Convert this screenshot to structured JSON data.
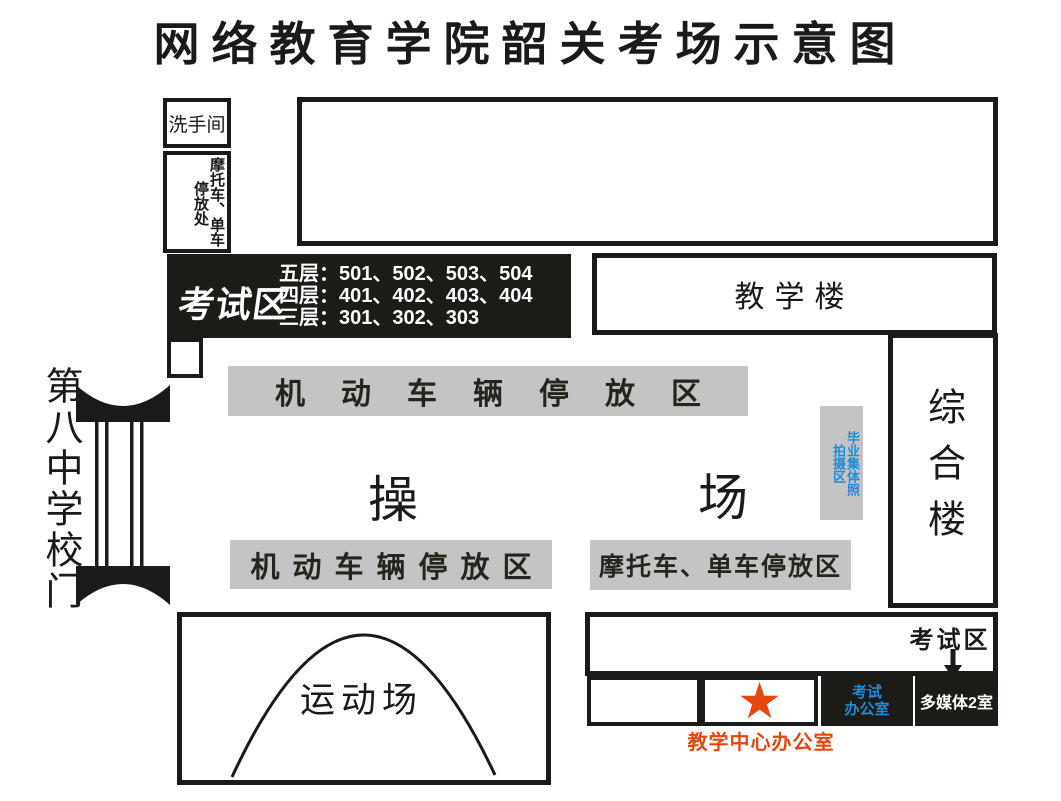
{
  "title": "网络教育学院韶关考场示意图",
  "colors": {
    "ink": "#1A1A1A",
    "accent_red": "#E6460F",
    "accent_blue": "#1E8CD7",
    "parking_gray": "#C4C4C4"
  },
  "map": {
    "washroom": {
      "label": "洗手间"
    },
    "moto_shed": {
      "line_right": "摩托车、单车",
      "line_left": "停放处"
    },
    "exam_bar": {
      "label": "考试区",
      "floors": [
        "五层：501、502、503、504",
        "四层：401、402、403、404",
        "三层：301、302、303"
      ]
    },
    "teaching_building": {
      "label": "教学楼"
    },
    "complex_building": {
      "label": "综合楼"
    },
    "school_gate": {
      "label": "第八中学校门"
    },
    "playground": {
      "chars": [
        "操",
        "场"
      ]
    },
    "parking_top": {
      "label": "机动车辆停放区"
    },
    "parking_bottom": {
      "label": "机动车辆停放区"
    },
    "moto_parking_bottom": {
      "label": "摩托车、单车停放区"
    },
    "photo_area": {
      "line_right": "毕业集体照",
      "line_left": "拍摄区"
    },
    "sports_field": {
      "label": "运动场"
    },
    "exam_zone_south": {
      "label": "考试区"
    },
    "exam_office": {
      "line1": "考试",
      "line2": "办公室"
    },
    "multimedia_room": {
      "label": "多媒体2室"
    },
    "teaching_center_office": {
      "label": "教学中心办公室"
    },
    "star": {
      "glyph": "★"
    }
  }
}
